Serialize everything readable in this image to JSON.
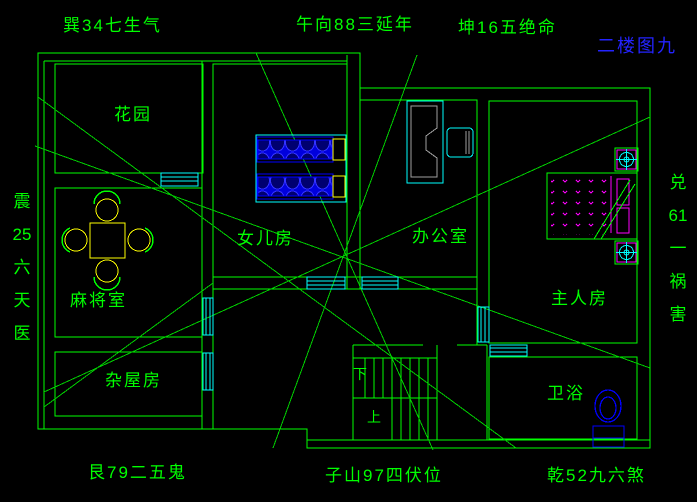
{
  "title": "二楼图九",
  "compass": {
    "top_left": "巽34七生气",
    "top_center": "午向88三延年",
    "top_right": "坤16五绝命",
    "bottom_left": "艮79二五鬼",
    "bottom_center": "子山97四伏位",
    "bottom_right": "乾52九六煞",
    "left_column": [
      "震",
      "25",
      "六",
      "天",
      "医"
    ],
    "right_column": [
      "兑",
      "61",
      "一",
      "祸",
      "害"
    ]
  },
  "rooms": {
    "garden": "花园",
    "mahjong": "麻将室",
    "storage": "杂屋房",
    "daughter": "女儿房",
    "office": "办公室",
    "master": "主人房",
    "bathroom": "卫浴",
    "stair_down": "下",
    "stair_up": "上"
  },
  "palette": {
    "background": "#000000",
    "wall_green": "#00ff00",
    "window_cyan": "#00ffff",
    "furniture_yellow": "#ffff00",
    "bed_blue": "#0000ff",
    "accent_magenta": "#ff00ff",
    "desk_gray": "#a0a0a0",
    "title_blue": "#2323ff"
  }
}
